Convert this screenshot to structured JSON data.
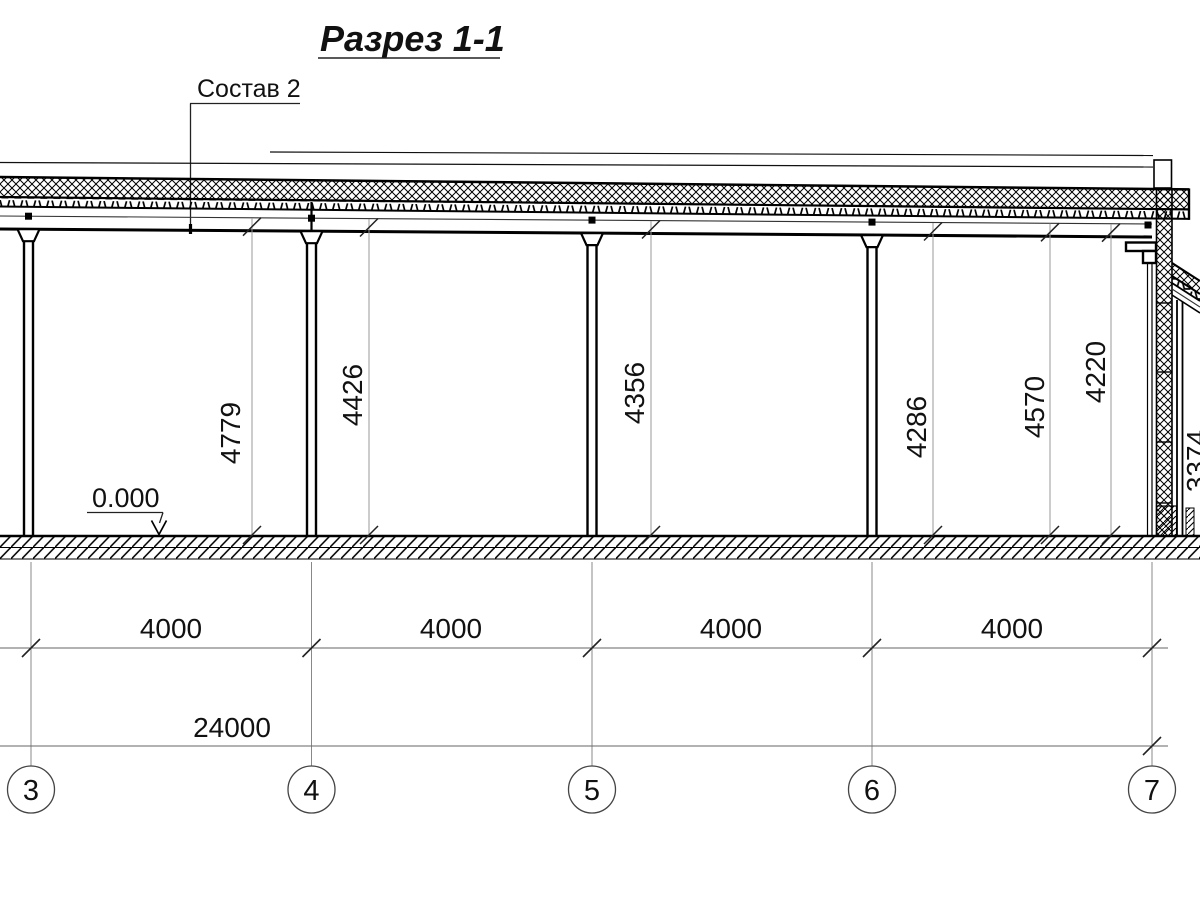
{
  "drawing": {
    "title": "Разрез 1-1",
    "callout_label": "Состав 2",
    "level_mark": "0.000",
    "vertical_dimensions": [
      {
        "value": "4779"
      },
      {
        "value": "4426"
      },
      {
        "value": "4356"
      },
      {
        "value": "4286"
      },
      {
        "value": "4570"
      },
      {
        "value": "4220"
      },
      {
        "value": "3374"
      }
    ],
    "bay_dimensions": [
      {
        "value": "4000"
      },
      {
        "value": "4000"
      },
      {
        "value": "4000"
      },
      {
        "value": "4000"
      }
    ],
    "overall_dimension": "24000",
    "grid_axes": [
      {
        "label": "3"
      },
      {
        "label": "4"
      },
      {
        "label": "5"
      },
      {
        "label": "6"
      },
      {
        "label": "7"
      }
    ]
  }
}
